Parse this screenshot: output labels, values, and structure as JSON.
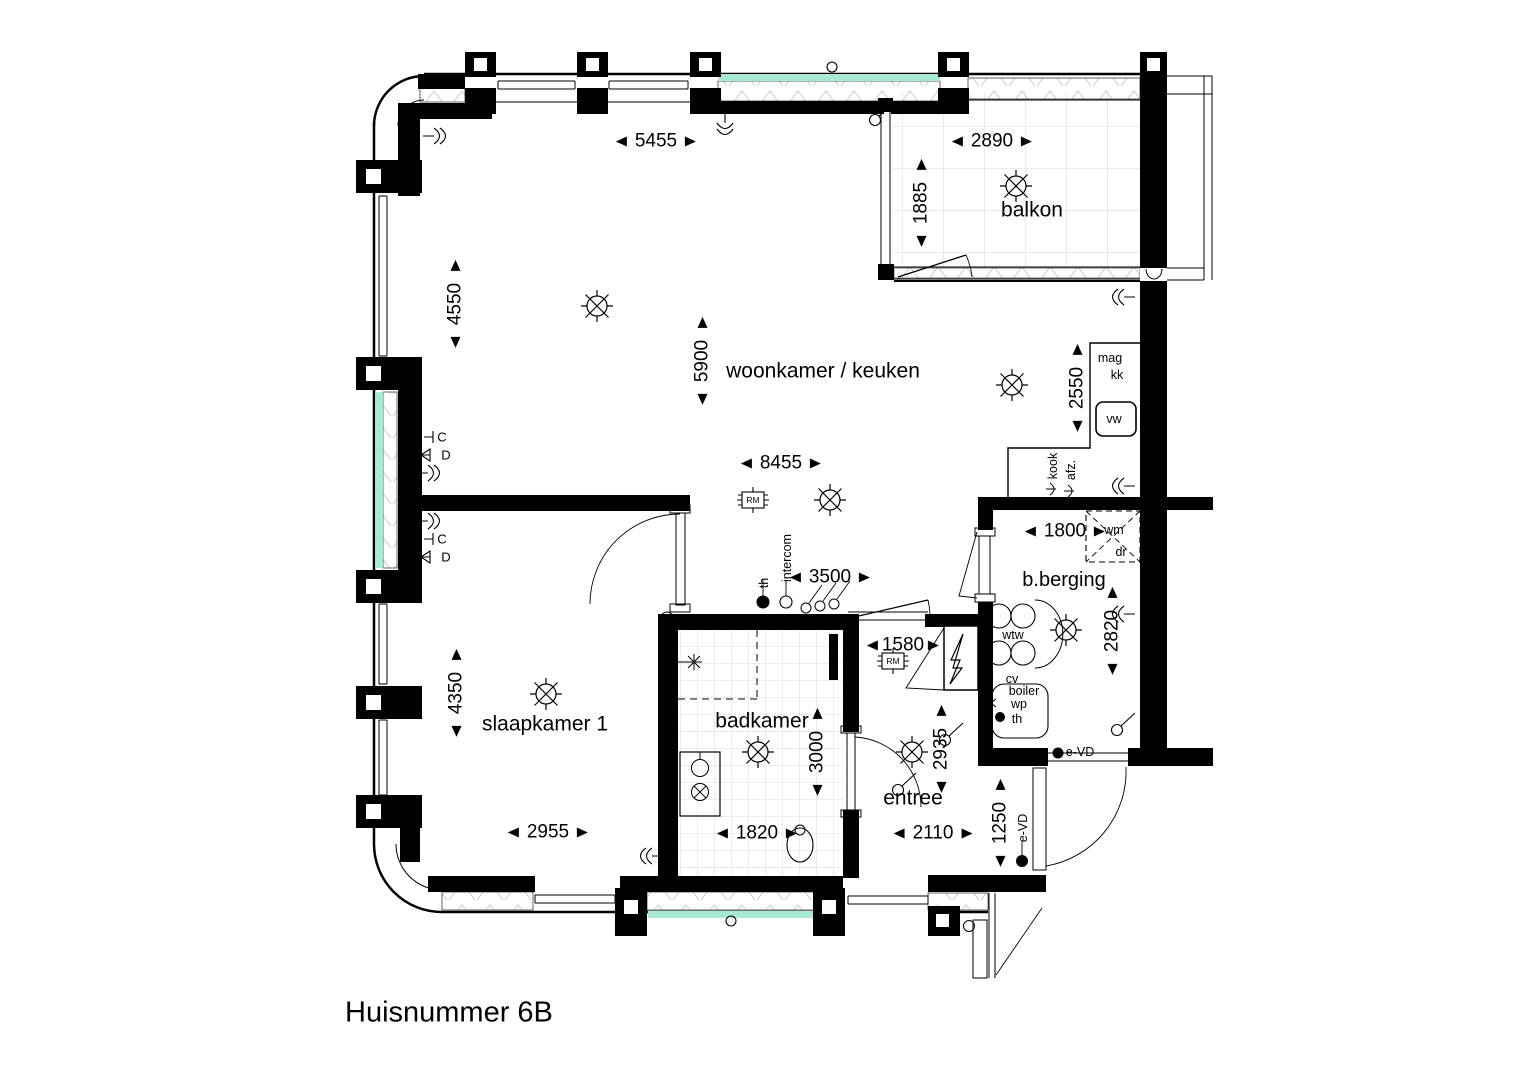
{
  "title": "Huisnummer 6B",
  "rooms": {
    "woonkamer": "woonkamer / keuken",
    "balkon": "balkon",
    "slaapkamer": "slaapkamer 1",
    "badkamer": "badkamer",
    "entree": "entree",
    "berging": "b.berging"
  },
  "dims": {
    "top_window": "5455",
    "balkon_w": "2890",
    "balkon_d": "1885",
    "left_window": "4550",
    "woon_h": "5900",
    "keuken_d": "2550",
    "woon_w": "8455",
    "berging_w": "1800",
    "hal_w": "3500",
    "berging_d": "2820",
    "slaap_h": "4350",
    "meterkast_w": "1580",
    "badkamer_h": "3000",
    "entree_h": "2935",
    "slaap_w": "2955",
    "badkamer_w": "1820",
    "entree_w": "2110",
    "voordeur": "1250"
  },
  "labels": {
    "mag": "mag",
    "kk": "kk",
    "vw": "vw",
    "kook": "kook",
    "afz": "afz.",
    "wm": "wm",
    "dr": "dr",
    "wtw": "wtw",
    "cv": "cv",
    "boiler": "boiler",
    "wp": "wp",
    "th": "th",
    "intercom": "intercom",
    "evd": "e-VD",
    "c": "C",
    "d": "D",
    "rm": "RM"
  },
  "colors": {
    "wall": "#000000",
    "glass": "#a9e9cf",
    "tile_line": "#d6d6d6",
    "hatch_line": "#c9c9c9"
  }
}
